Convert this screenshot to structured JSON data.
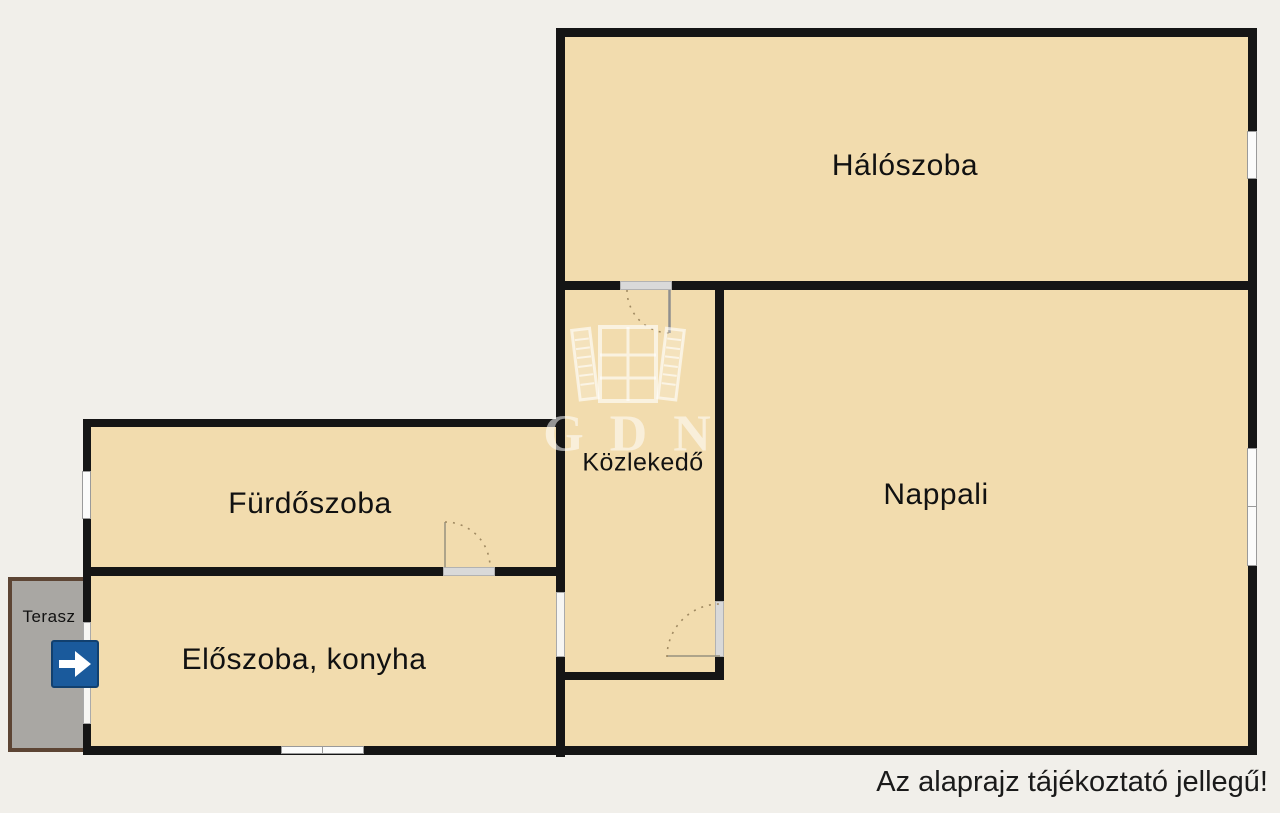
{
  "page": {
    "background_color": "#f1efea",
    "disclaimer": "Az alaprajz tájékoztató jellegű!"
  },
  "colors": {
    "wall": "#151515",
    "room_fill": "#f2dcae",
    "terrace_fill": "#a9a7a3",
    "terrace_border": "#5d4534",
    "entrance_arrow_background": "#1a5a9c",
    "label_text": "#111111",
    "window_fill": "#fbfbfa"
  },
  "rooms": [
    {
      "id": "haloszoba",
      "label": "Hálószoba"
    },
    {
      "id": "nappali",
      "label": "Nappali"
    },
    {
      "id": "kozlekedo",
      "label": "Közlekedő"
    },
    {
      "id": "furdoszoba",
      "label": "Fürdőszoba"
    },
    {
      "id": "eloszoba_konyha",
      "label": "Előszoba, konyha"
    },
    {
      "id": "terasz",
      "label": "Terasz"
    }
  ],
  "watermark": {
    "text": "GDN",
    "icon": "open-window-icon"
  }
}
